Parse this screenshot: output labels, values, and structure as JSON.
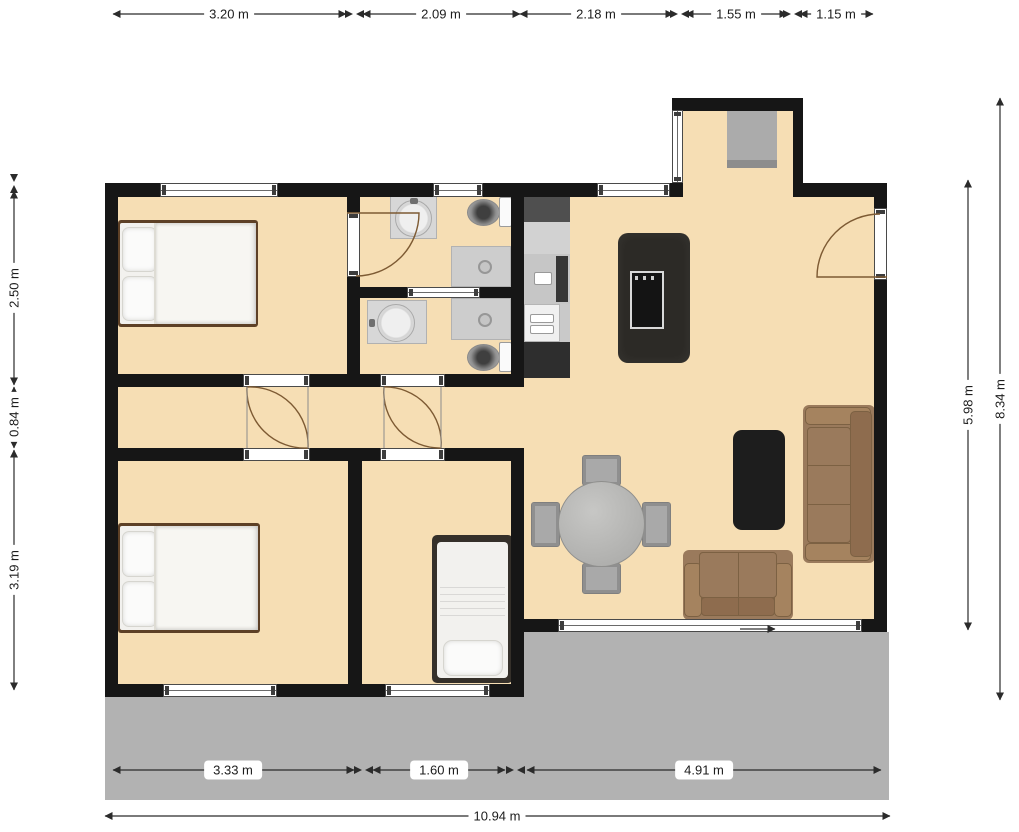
{
  "dimensions": {
    "top": [
      "3.20 m",
      "2.09 m",
      "2.18 m",
      "1.55 m",
      "1.15 m"
    ],
    "left": [
      "2.50 m",
      "0.84 m",
      "3.19 m"
    ],
    "right": [
      "5.98 m",
      "8.34 m"
    ],
    "bottom": [
      "3.33 m",
      "1.60 m",
      "4.91 m"
    ],
    "overall_width": "10.94 m"
  },
  "colors": {
    "floor": "#f6deb4",
    "walls": "#161616",
    "terrace": "#b2b2b2",
    "sofa": "#9a7a5c",
    "island": "#2c2a26",
    "door_arc": "#7d5a33",
    "dimension_text": "#1c1c1c"
  }
}
